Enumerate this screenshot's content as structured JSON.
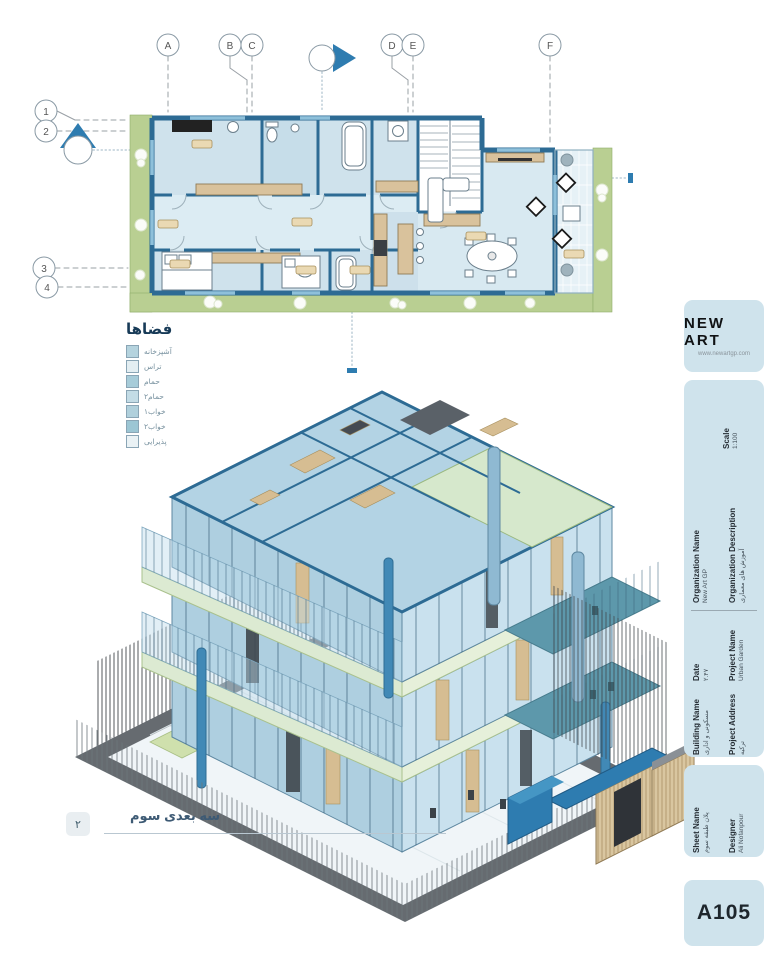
{
  "sheet": {
    "background": "#ffffff"
  },
  "plan": {
    "grid_cols": [
      {
        "label": "A"
      },
      {
        "label": "B"
      },
      {
        "label": "C"
      },
      {
        "label": "D"
      },
      {
        "label": "E"
      },
      {
        "label": "F"
      }
    ],
    "grid_rows": [
      {
        "label": "1"
      },
      {
        "label": "2"
      },
      {
        "label": "3"
      },
      {
        "label": "4"
      }
    ]
  },
  "legend": {
    "title": "فضاها",
    "items": [
      {
        "label": "آشپزخانه",
        "color": "#b5d3de"
      },
      {
        "label": "تراس",
        "color": "#e3eef2"
      },
      {
        "label": "حمام",
        "color": "#a7ccd9"
      },
      {
        "label": "حمام۲",
        "color": "#c3dce6"
      },
      {
        "label": "خواب۱",
        "color": "#b0d0dc"
      },
      {
        "label": "خواب۲",
        "color": "#9cc6d4"
      },
      {
        "label": "پذیرایی",
        "color": "#eaf2f5"
      }
    ]
  },
  "view_label": {
    "number": "۲",
    "text": "سه بعدی سوم"
  },
  "titleblock": {
    "logo": {
      "name": "NEW ART",
      "url": "www.newartgp.com"
    },
    "scale": {
      "label": "Scale",
      "value": "1:100"
    },
    "organization_name": {
      "label": "Organization Name",
      "value": "New Art GP"
    },
    "organization_description": {
      "label": "Organization Description",
      "value": "آموزش های معماری"
    },
    "project_name": {
      "label": "Project Name",
      "value": "Urban Garden"
    },
    "date": {
      "label": "Date",
      "value": "۲.۴۷"
    },
    "building_name": {
      "label": "Building Name",
      "value": "مسکونی و اداری"
    },
    "project_address": {
      "label": "Project Address",
      "value": "ترکیه"
    },
    "sheet_name": {
      "label": "Sheet Name",
      "value": "پلان طبقه سوم"
    },
    "designer": {
      "label": "Designer",
      "value": "Ali Nofanpour"
    },
    "sheet_number": "A105"
  }
}
